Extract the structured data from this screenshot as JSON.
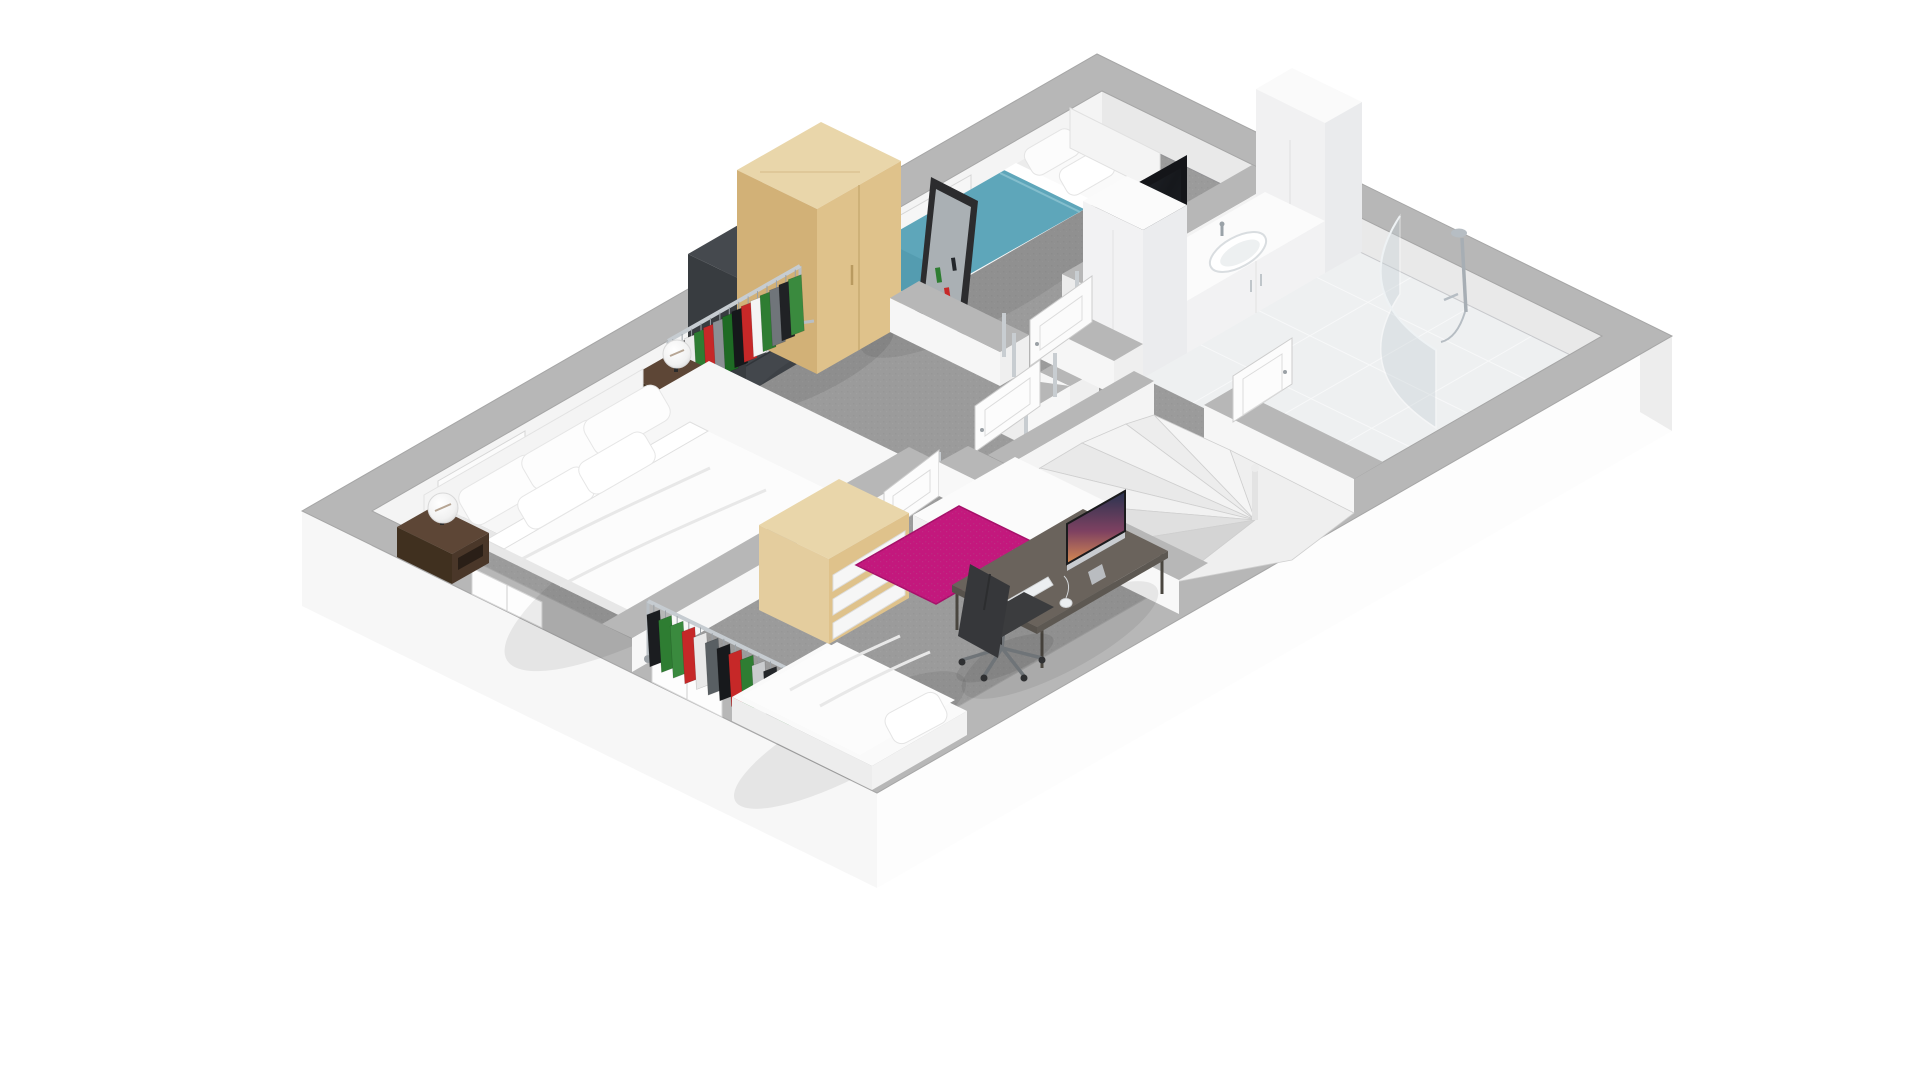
{
  "canvas": {
    "width": 1920,
    "height": 1080,
    "background": "#ffffff"
  },
  "scene": {
    "kind": "3d-floor-plan-cutaway-render",
    "floor": "upper floor with three bedrooms, bathroom and winder staircase",
    "rooms": [
      {
        "id": "master-bedroom",
        "label": "master bedroom",
        "furniture": [
          "double bed",
          "headboard",
          "left nightstand",
          "right nightstand",
          "two white globe table lamps",
          "clothes rack with garments",
          "dark dresser",
          "light wood wardrobe",
          "leaning floor mirror"
        ]
      },
      {
        "id": "small-bedroom",
        "label": "small bedroom",
        "furniture": [
          "single bed with teal blanket",
          "white pillows",
          "white headboard",
          "flat-screen tv on dark stand"
        ]
      },
      {
        "id": "third-bedroom",
        "label": "third bedroom",
        "furniture": [
          "single bed",
          "clothes rack with garments",
          "light wood shelf unit with white drawers",
          "white storage chest",
          "pink rug",
          "desk",
          "all-in-one computer",
          "white keyboard",
          "white mouse",
          "dark office chair"
        ]
      },
      {
        "id": "bathroom",
        "label": "bathroom",
        "furniture": [
          "vanity cabinet with oval sink and faucet",
          "tall cabinet left",
          "tall cabinet right",
          "curved glass shower screen",
          "chrome shower fixture",
          "white tile floor"
        ]
      },
      {
        "id": "hallway",
        "label": "hallway landing",
        "furniture": [
          "four open panel doors",
          "chrome door posts"
        ]
      },
      {
        "id": "staircase",
        "label": "winder staircase",
        "furniture": [
          "fanned treads",
          "newel post",
          "stairwell walls"
        ]
      }
    ]
  },
  "palette": {
    "bg": "#ffffff",
    "carpet": "#9b9b9b",
    "carpet_dark": "#8d8d8d",
    "wall_top": "#b7b7b7",
    "wall_inner": "#f5f5f5",
    "wall_inner_shade": "#e9e9e9",
    "exterior_face": "#f7f7f7",
    "exterior_face_bright": "#fdfdfd",
    "tile": "#eef0f1",
    "bedding": "#fafafa",
    "bedding_shade": "#e8e8e8",
    "teal": "#5ea6ba",
    "teal_dark": "#4f97ab",
    "pink": "#c3187d",
    "wood": "#e9d6aa",
    "wood_mid": "#dfc28b",
    "wood_dark": "#d2b177",
    "walnut": "#5d4636",
    "walnut_dark": "#40301f",
    "dresser": "#45494e",
    "dresser_dark": "#383c40",
    "tv": "#141519",
    "chrome": "#b4bbc1",
    "desk": "#6a635c",
    "chair": "#3b3c3e"
  },
  "clothes_racks": [
    {
      "id": "master-rack",
      "colors": [
        "#23262a",
        "#111317",
        "#ececec",
        "#2e7d32",
        "#c62828",
        "#8b9094",
        "#1e6b24",
        "#16181b",
        "#c62828",
        "#f4f4f4",
        "#2e7d32",
        "#70757a",
        "#202225",
        "#3a8a3e"
      ]
    },
    {
      "id": "third-rack",
      "colors": [
        "#1b1d20",
        "#2e7d32",
        "#3a8a3e",
        "#c62828",
        "#e9e9e9",
        "#595f63",
        "#17191c",
        "#c62828",
        "#2e7d32",
        "#caccce",
        "#24272a",
        "#2e7d32"
      ]
    }
  ],
  "computer_wallpaper": {
    "top": "#28334f",
    "mid": "#7e4161",
    "bottom": "#d88c52"
  }
}
